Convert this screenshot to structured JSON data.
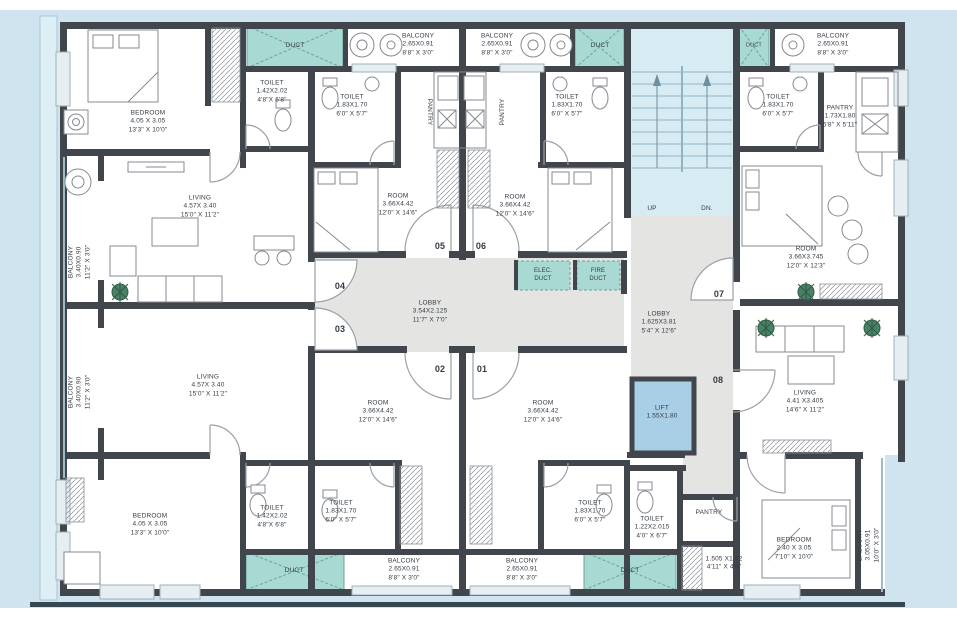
{
  "palette": {
    "background_blue": "#cfe4ee",
    "wall_dark": "#41464c",
    "duct_teal": "#a8d9d2",
    "duct_border": "#68a49c",
    "lobby_gray": "#e4e4e3",
    "lift_blue": "#a9cfe6",
    "stairs_blue": "#d7ebf3",
    "plant_green": "#4a8065",
    "text_color": "#343b42"
  },
  "labels": [
    {
      "n": "bedroom-top-left",
      "x": 148,
      "y": 122,
      "lines": [
        "BEDROOM",
        "4.05 X 3.05",
        "13'3\" X 10'0\""
      ]
    },
    {
      "n": "duct-top-1",
      "x": 295,
      "y": 46,
      "lines": [
        "DUCT"
      ]
    },
    {
      "n": "balcony-top-1",
      "x": 418,
      "y": 45,
      "lines": [
        "BALCONY",
        "2.65X0.91",
        "8'8\" X 3'0\""
      ]
    },
    {
      "n": "balcony-top-2",
      "x": 497,
      "y": 45,
      "lines": [
        "BALCONY",
        "2.65X0.91",
        "8'8\" X 3'0\""
      ]
    },
    {
      "n": "duct-top-2",
      "x": 600,
      "y": 46,
      "lines": [
        "DUCT"
      ]
    },
    {
      "n": "duct-top-3",
      "x": 754,
      "y": 46,
      "fs": 5.5,
      "lines": [
        "DUCT"
      ]
    },
    {
      "n": "balcony-top-3",
      "x": 833,
      "y": 45,
      "lines": [
        "BALCONY",
        "2.65X0.91",
        "8'8\" X 3'0\""
      ]
    },
    {
      "n": "toilet-top-left-1",
      "x": 272,
      "y": 92,
      "lines": [
        "TOILET",
        "1.42X2.02",
        "4'8\"X 6'8\""
      ]
    },
    {
      "n": "toilet-top-left-2",
      "x": 352,
      "y": 106,
      "lines": [
        "TOILET",
        "1.83X1.70",
        "6'0\" X 5'7\""
      ]
    },
    {
      "n": "pantry-left-vertical",
      "x": 429,
      "y": 112,
      "rot": 90,
      "lines": [
        "PANTRY"
      ]
    },
    {
      "n": "pantry-right-vertical",
      "x": 503,
      "y": 112,
      "rot": -90,
      "lines": [
        "PANTRY"
      ]
    },
    {
      "n": "toilet-top-right-1",
      "x": 567,
      "y": 106,
      "lines": [
        "TOILET",
        "1.83X1.70",
        "6'0\" X 5'7\""
      ]
    },
    {
      "n": "toilet-top-right-2",
      "x": 778,
      "y": 106,
      "lines": [
        "TOILET",
        "1.83X1.70",
        "6'0\" X 5'7\""
      ]
    },
    {
      "n": "pantry-top-right",
      "x": 840,
      "y": 117,
      "lines": [
        "PANTRY",
        "1.73X1.80",
        "5'8\" X 5'11\""
      ]
    },
    {
      "n": "living-top-left",
      "x": 200,
      "y": 207,
      "lines": [
        "LIVING",
        "4.57X 3.40",
        "15'0\" X 11'2\""
      ]
    },
    {
      "n": "balcony-left-1",
      "x": 80,
      "y": 262,
      "rot": -90,
      "lines": [
        "BALCONY",
        "3.40X0.90",
        "11'2\" X 3'0\""
      ]
    },
    {
      "n": "balcony-left-2",
      "x": 80,
      "y": 392,
      "rot": -90,
      "lines": [
        "BALCONY",
        "3.40X0.90",
        "11'2\" X 3'0\""
      ]
    },
    {
      "n": "room-05",
      "x": 398,
      "y": 205,
      "lines": [
        "ROOM",
        "3.66X4.42",
        "12'0\" X 14'6\""
      ]
    },
    {
      "n": "room-06",
      "x": 515,
      "y": 206,
      "lines": [
        "ROOM",
        "3.66X4.42",
        "12'0\" X 14'6\""
      ]
    },
    {
      "n": "door-05",
      "x": 440,
      "y": 247,
      "b": 1,
      "fs": 9,
      "lines": [
        "05"
      ]
    },
    {
      "n": "door-06",
      "x": 481,
      "y": 247,
      "b": 1,
      "fs": 9,
      "lines": [
        "06"
      ]
    },
    {
      "n": "door-04",
      "x": 340,
      "y": 287,
      "b": 1,
      "fs": 9,
      "lines": [
        "04"
      ]
    },
    {
      "n": "door-03",
      "x": 340,
      "y": 330,
      "b": 1,
      "fs": 9,
      "lines": [
        "03"
      ]
    },
    {
      "n": "lobby-main",
      "x": 430,
      "y": 312,
      "lines": [
        "LOBBY",
        "3.54X2.125",
        "11'7\" X 7'0\""
      ]
    },
    {
      "n": "elec-duct",
      "x": 543,
      "y": 276,
      "fs": 6,
      "lines": [
        "ELEC.",
        "DUCT"
      ]
    },
    {
      "n": "fire-duct",
      "x": 598,
      "y": 276,
      "fs": 6,
      "lines": [
        "FIRE",
        "DUCT"
      ]
    },
    {
      "n": "stairs-up",
      "x": 652,
      "y": 209,
      "lines": [
        "UP"
      ]
    },
    {
      "n": "stairs-dn",
      "x": 707,
      "y": 209,
      "lines": [
        "DN."
      ]
    },
    {
      "n": "lobby-right",
      "x": 659,
      "y": 323,
      "lines": [
        "LOBBY",
        "1.625X3.81",
        "5'4\" X 12'6\""
      ]
    },
    {
      "n": "door-07",
      "x": 719,
      "y": 295,
      "b": 1,
      "fs": 9,
      "lines": [
        "07"
      ]
    },
    {
      "n": "room-top-right",
      "x": 806,
      "y": 258,
      "lines": [
        "ROOM",
        "3.66X3.745",
        "12'0\" X 12'3\""
      ]
    },
    {
      "n": "lift",
      "x": 662,
      "y": 413,
      "lines": [
        "LIFT",
        "1.55X1.80"
      ]
    },
    {
      "n": "door-08",
      "x": 718,
      "y": 381,
      "b": 1,
      "fs": 9,
      "lines": [
        "08"
      ]
    },
    {
      "n": "living-right",
      "x": 805,
      "y": 402,
      "lines": [
        "LIVING",
        "4.41 X3.405",
        "14'6\" X 11'2\""
      ]
    },
    {
      "n": "room-02",
      "x": 378,
      "y": 412,
      "lines": [
        "ROOM",
        "3.66X4.42",
        "12'0\" X 14'6\""
      ]
    },
    {
      "n": "room-01",
      "x": 543,
      "y": 412,
      "lines": [
        "ROOM",
        "3.66X4.42",
        "12'0\" X 14'6\""
      ]
    },
    {
      "n": "door-02",
      "x": 440,
      "y": 370,
      "b": 1,
      "fs": 9,
      "lines": [
        "02"
      ]
    },
    {
      "n": "door-01",
      "x": 482,
      "y": 370,
      "b": 1,
      "fs": 9,
      "lines": [
        "01"
      ]
    },
    {
      "n": "living-bottom-left",
      "x": 208,
      "y": 386,
      "lines": [
        "LIVING",
        "4.57X 3.40",
        "15'0\" X 11'2\""
      ]
    },
    {
      "n": "bedroom-bottom-left",
      "x": 150,
      "y": 525,
      "lines": [
        "BEDROOM",
        "4.05 X 3.05",
        "13'3\" X 10'0\""
      ]
    },
    {
      "n": "toilet-bottom-left-1",
      "x": 272,
      "y": 517,
      "lines": [
        "TOILET",
        "1.42X2.02",
        "4'8\"X 6'8\""
      ]
    },
    {
      "n": "toilet-bottom-left-2",
      "x": 341,
      "y": 512,
      "lines": [
        "TOILET",
        "1.83X1.70",
        "6'0\" X 5'7\""
      ]
    },
    {
      "n": "duct-bottom-1",
      "x": 294,
      "y": 571,
      "lines": [
        "DUCT"
      ]
    },
    {
      "n": "balcony-bottom-1",
      "x": 404,
      "y": 570,
      "lines": [
        "BALCONY",
        "2.65X0.91",
        "8'8\" X 3'0\""
      ]
    },
    {
      "n": "balcony-bottom-2",
      "x": 522,
      "y": 570,
      "lines": [
        "BALCONY",
        "2.65X0.91",
        "8'8\" X 3'0\""
      ]
    },
    {
      "n": "toilet-bottom-right-1",
      "x": 590,
      "y": 512,
      "lines": [
        "TOILET",
        "1.83X1.70",
        "6'0\" X 5'7\""
      ]
    },
    {
      "n": "toilet-bottom-right-2",
      "x": 652,
      "y": 528,
      "lines": [
        "TOILET",
        "1.22X2.015",
        "4'0\" X 6'7\""
      ]
    },
    {
      "n": "duct-bottom-2",
      "x": 630,
      "y": 571,
      "lines": [
        "DUCT"
      ]
    },
    {
      "n": "pantry-bottom-right",
      "x": 709,
      "y": 513,
      "lines": [
        "PANTRY"
      ]
    },
    {
      "n": "passage-bottom-right",
      "x": 724,
      "y": 564,
      "lines": [
        "1.505 X1.42",
        "4'11\" X 4'8\""
      ]
    },
    {
      "n": "bedroom-bottom-right",
      "x": 794,
      "y": 549,
      "lines": [
        "BEDROOM",
        "2.40 X 3.05",
        "7'10\" X 10'0\""
      ]
    },
    {
      "n": "balcony-bottom-right",
      "x": 869,
      "y": 545,
      "rot": -90,
      "lines": [
        "BALCONY",
        "3.05X0.91",
        "10'0\" X 3'0\""
      ]
    }
  ]
}
